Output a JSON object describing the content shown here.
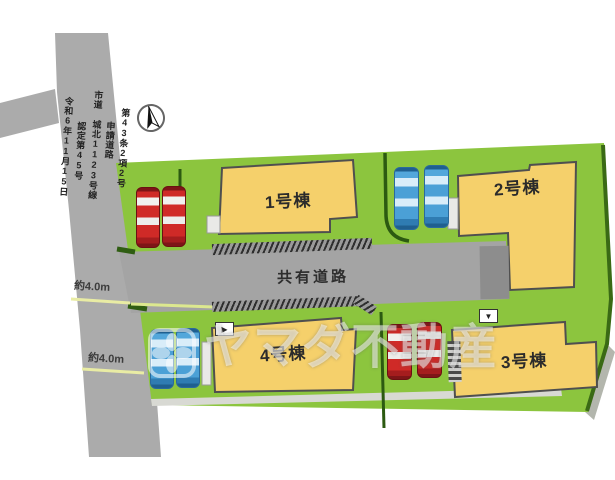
{
  "plan": {
    "title_context": "site-plan",
    "shared_road_label": "共有道路",
    "measurements": [
      "約4.0m",
      "約4.0m"
    ],
    "road_text": [
      "第43条2項2号",
      "申請道路",
      "市道 城北1123号線",
      "認定第45号",
      "令和6年11月15日"
    ],
    "buildings": [
      {
        "label": "1号棟"
      },
      {
        "label": "2号棟"
      },
      {
        "label": "3号棟"
      },
      {
        "label": "4号棟"
      }
    ],
    "parking": [
      {
        "building": "1号棟",
        "cars": 2,
        "car_color": "red"
      },
      {
        "building": "2号棟",
        "cars": 2,
        "car_color": "blue"
      },
      {
        "building": "3号棟",
        "cars": 2,
        "car_color": "red"
      },
      {
        "building": "4号棟",
        "cars": 2,
        "car_color": "blue"
      }
    ],
    "markers": {
      "building3": "▼",
      "building4": "▶"
    },
    "compass": {
      "type": "north-arrow"
    },
    "watermark": {
      "text": "ヤマダ不動産",
      "logo": "flower-logo"
    },
    "colors": {
      "plot_green": "#8cc53e",
      "road_gray": "#a9a9a9",
      "building_fill": "#f5d06b",
      "building_outline": "#4f4f4f",
      "boundary_green": "#2c5a11",
      "tick_yellow": "#e9eca4",
      "car_red": "#cf2a27",
      "car_blue": "#53a7db"
    }
  }
}
